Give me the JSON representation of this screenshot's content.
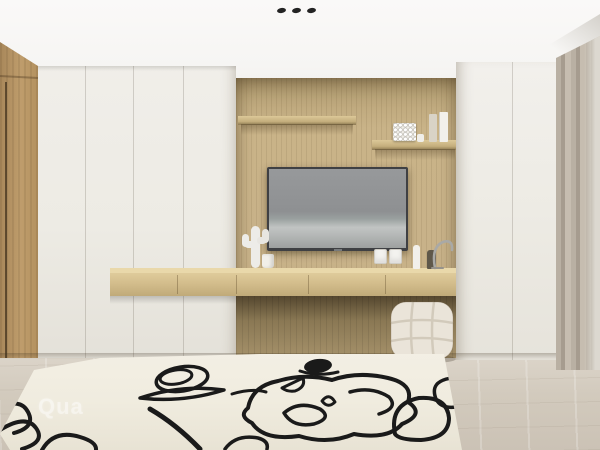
{
  "scene": {
    "type": "3d-interior-render",
    "subject": "minimalist bedroom TV wall with built-in white wardrobes, wood feature wall, floating console, tufted pouf and abstract line-art rug",
    "watermark": "Qua"
  },
  "palette": {
    "ceiling": "#f6f5f3",
    "wood_wall": "#c8b289",
    "wood_door": "#b6945f",
    "console_wood": "#d3bd8c",
    "cabinet_white": "#edebe4",
    "floor_top": "#ddd6cb",
    "floor_bottom": "#cbc2b5",
    "curtain": "#b4ab9e",
    "rug_base": "#f0ecdf",
    "rug_line": "#1a1a1a",
    "tv_frame": "#3f4043",
    "pouf": "#eae4d9"
  },
  "decor": {
    "ceiling_lights": 3,
    "shelf_items": [
      "bead-cube",
      "books",
      "mini-vase"
    ],
    "console_items": [
      "cactus-sculpture",
      "cup",
      "bud-vase",
      "dark-vase",
      "metal-arc"
    ]
  }
}
